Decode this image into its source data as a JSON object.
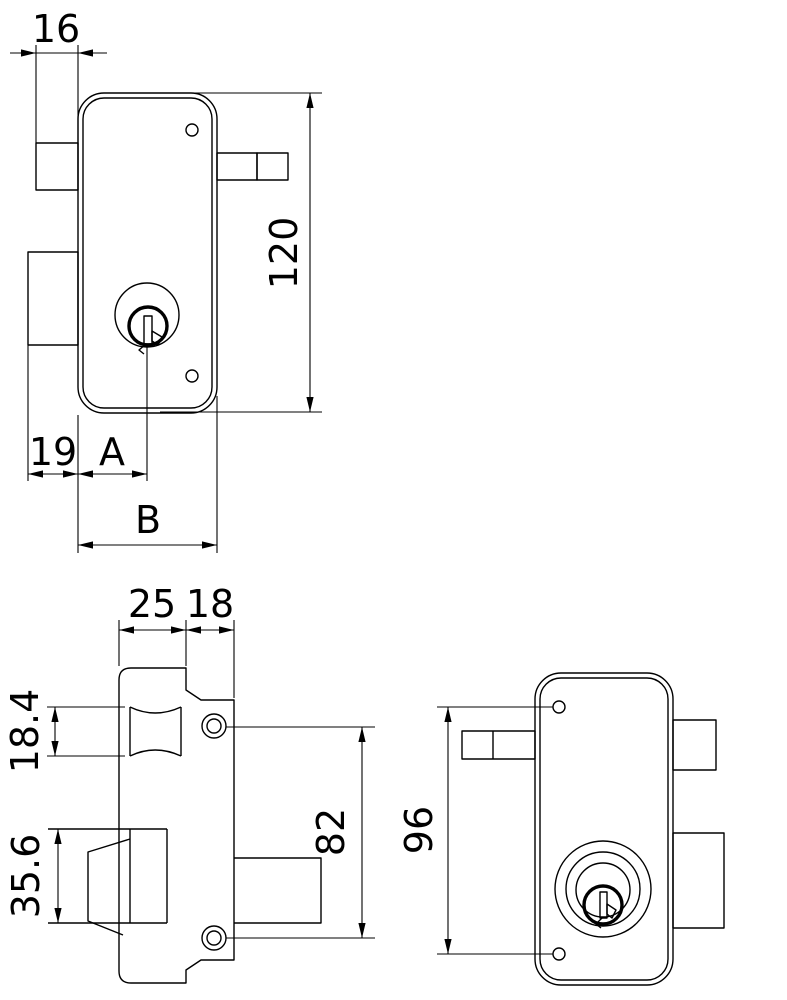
{
  "drawing": {
    "colors": {
      "line": "#000000",
      "background": "#ffffff"
    },
    "front_view": {
      "dim_latch_protrusion": "16",
      "dim_body_height": "120",
      "dim_edge_offset": "19",
      "dim_cylinder_backset": "A",
      "dim_body_width": "B"
    },
    "side_view": {
      "dim_case_depth": "25",
      "dim_faceplate_width": "18",
      "dim_latch_height": "18.4",
      "dim_bolt_height": "35.6",
      "dim_screw_spacing": "82"
    },
    "rear_view": {
      "dim_hole_spacing": "96"
    }
  }
}
